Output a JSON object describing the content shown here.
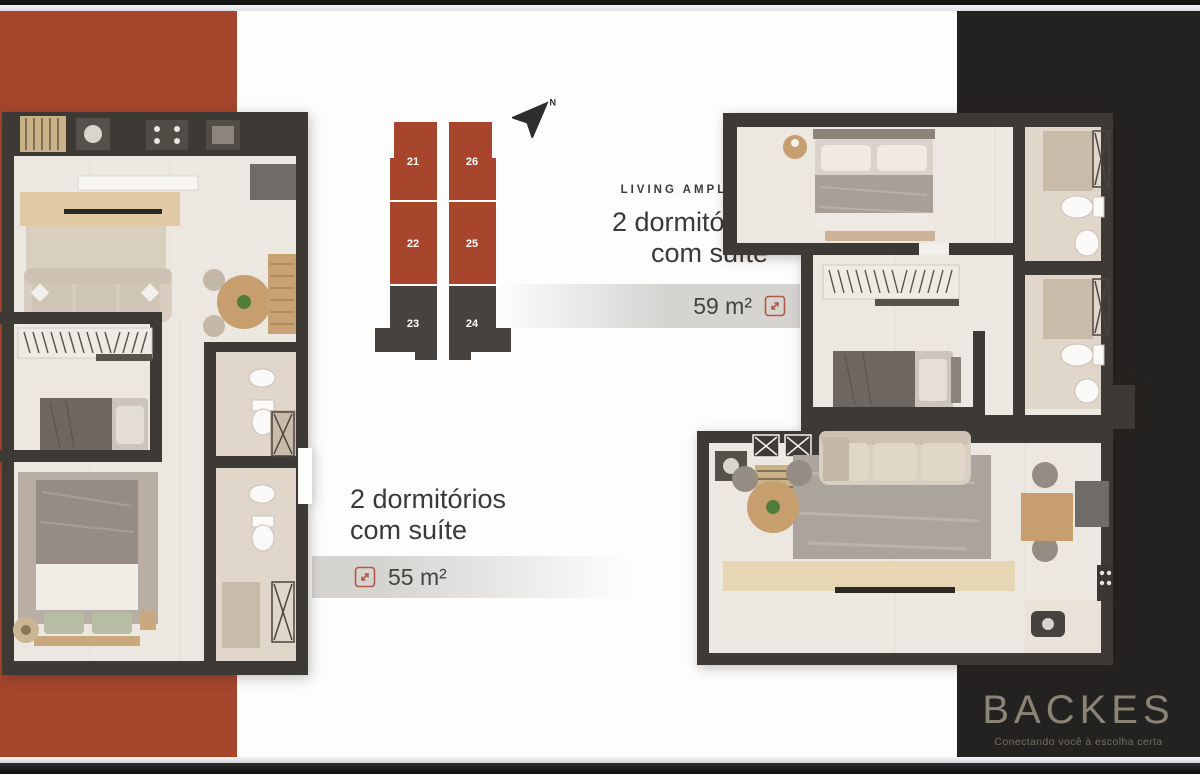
{
  "brand": {
    "name": "BACKES",
    "tagline": "Conectando você à escolha certa"
  },
  "compass": {
    "label": "N"
  },
  "keyplan": {
    "columns": [
      {
        "units": [
          {
            "label": "21"
          },
          {
            "label": "22"
          },
          {
            "label": "23"
          }
        ]
      },
      {
        "units": [
          {
            "label": "26"
          },
          {
            "label": "25"
          },
          {
            "label": "24"
          }
        ]
      }
    ]
  },
  "plans": [
    {
      "name": "planta 55",
      "title_line1": "2 dormitórios",
      "title_line2": "com suíte",
      "area": "55 m²"
    },
    {
      "name": "planta 59",
      "eyebrow": "LIVING AMPLIADO",
      "title_line1": "2 dormitórios",
      "title_line2": "com suíte",
      "area": "59 m²"
    }
  ],
  "colors": {
    "accent_orange": "#A4452C",
    "keyplan_dark": "#454240",
    "wall": "#3D3935",
    "floor": "#ECE7E0",
    "panel_black": "#242220",
    "expand_icon": "#B05A45"
  }
}
